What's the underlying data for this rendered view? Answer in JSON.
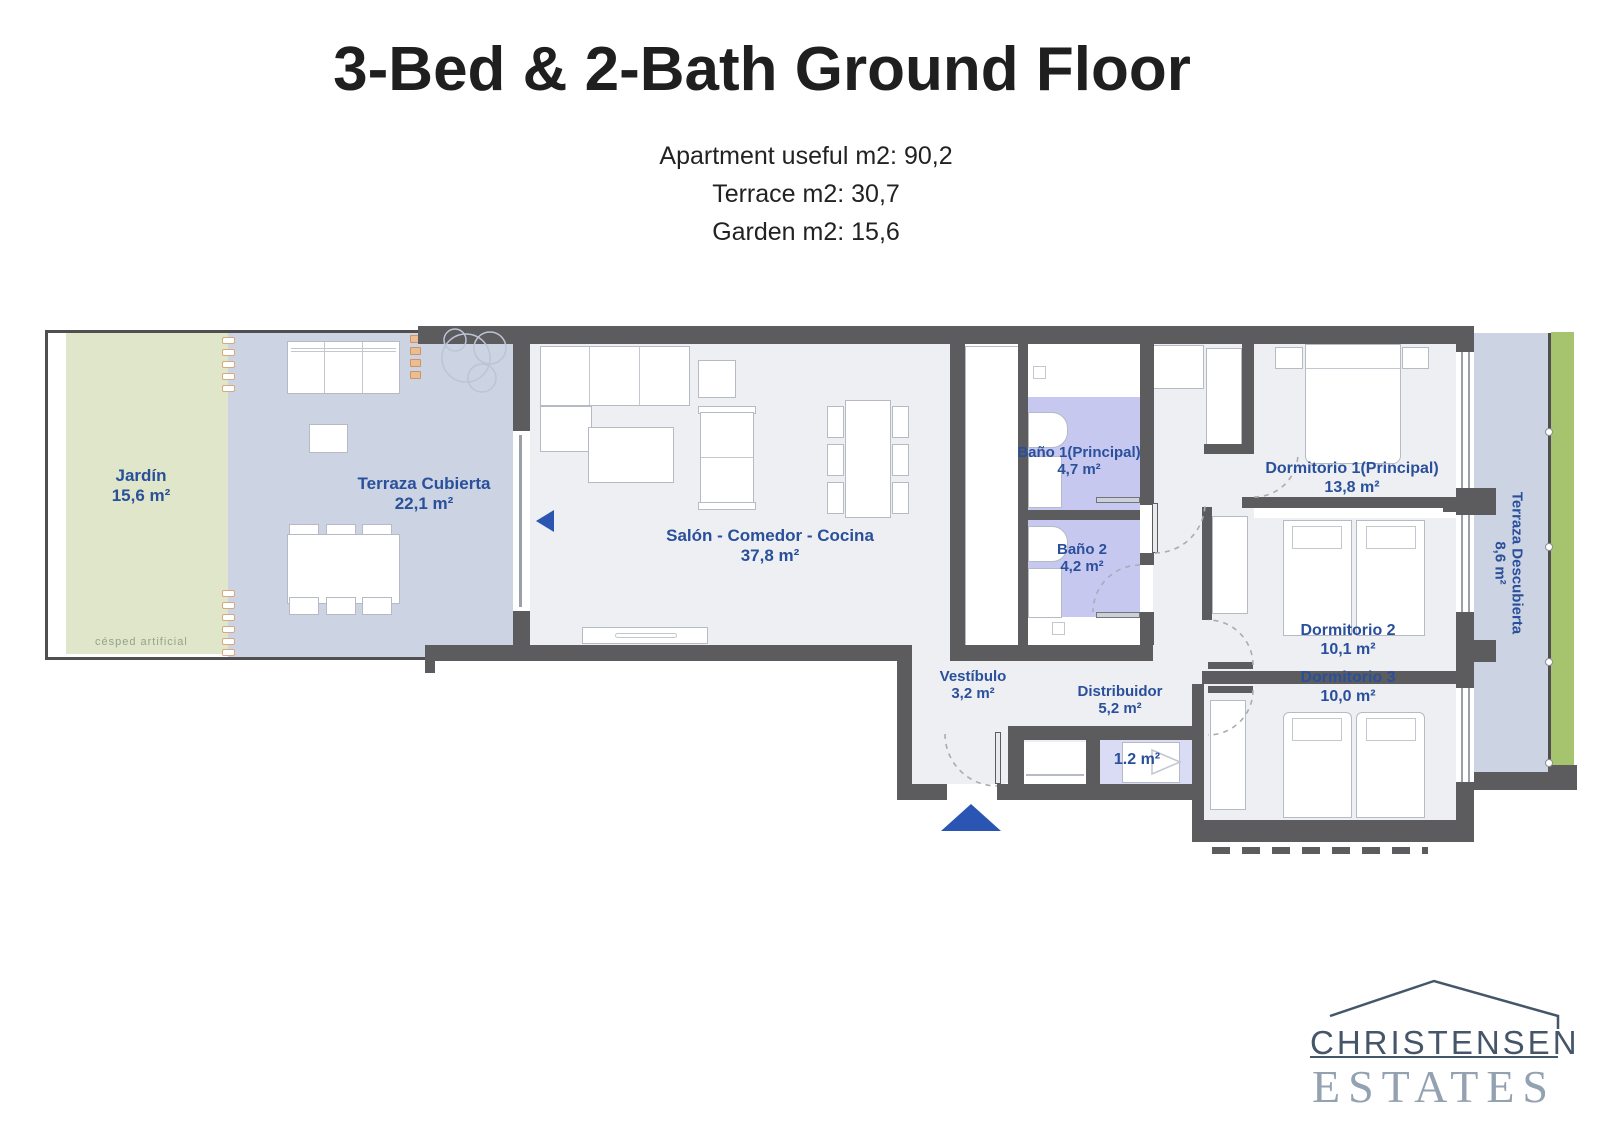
{
  "title": "3-Bed & 2-Bath Ground Floor",
  "subtitle": [
    "Apartment useful m2: 90,2",
    "Terrace m2: 30,7",
    "Garden m2: 15,6"
  ],
  "rooms": {
    "jardin": {
      "name": "Jardín",
      "area": "15,6 m²"
    },
    "terraza_cub": {
      "name": "Terraza Cubierta",
      "area": "22,1 m²"
    },
    "salon": {
      "name": "Salón - Comedor - Cocina",
      "area": "37,8 m²"
    },
    "bano1": {
      "name": "Baño 1(Principal)",
      "area": "4,7 m²"
    },
    "bano2": {
      "name": "Baño 2",
      "area": "4,2 m²"
    },
    "dorm1": {
      "name": "Dormitorio 1(Principal)",
      "area": "13,8 m²"
    },
    "dorm2": {
      "name": "Dormitorio 2",
      "area": "10,1 m²"
    },
    "dorm3": {
      "name": "Dormitorio 3",
      "area": "10,0 m²"
    },
    "vestibulo": {
      "name": "Vestíbulo",
      "area": "3,2 m²"
    },
    "distribuidor": {
      "name": "Distribuidor",
      "area": "5,2 m²"
    },
    "terraza_desc": {
      "name": "Terraza Descubierta",
      "area": "8,6 m²"
    },
    "storage": {
      "area": "1.2 m²"
    }
  },
  "annotations": {
    "grass": "césped artificial"
  },
  "logo": {
    "line1": "CHRISTENSEN",
    "line2": "ESTATES"
  },
  "colors": {
    "label_blue": "#2a4f9b",
    "wall_gray": "#5c5c5e",
    "garden_green": "#dfe6c9",
    "terrace_blue": "#ccd3e2",
    "interior_gray": "#edeff2",
    "bath_lavender": "#c7c8f0",
    "lawn_strip_green": "#a6c36e",
    "arrow_blue": "#2b55b2",
    "logo_dark": "#46566a",
    "logo_light": "#93a1b1"
  }
}
